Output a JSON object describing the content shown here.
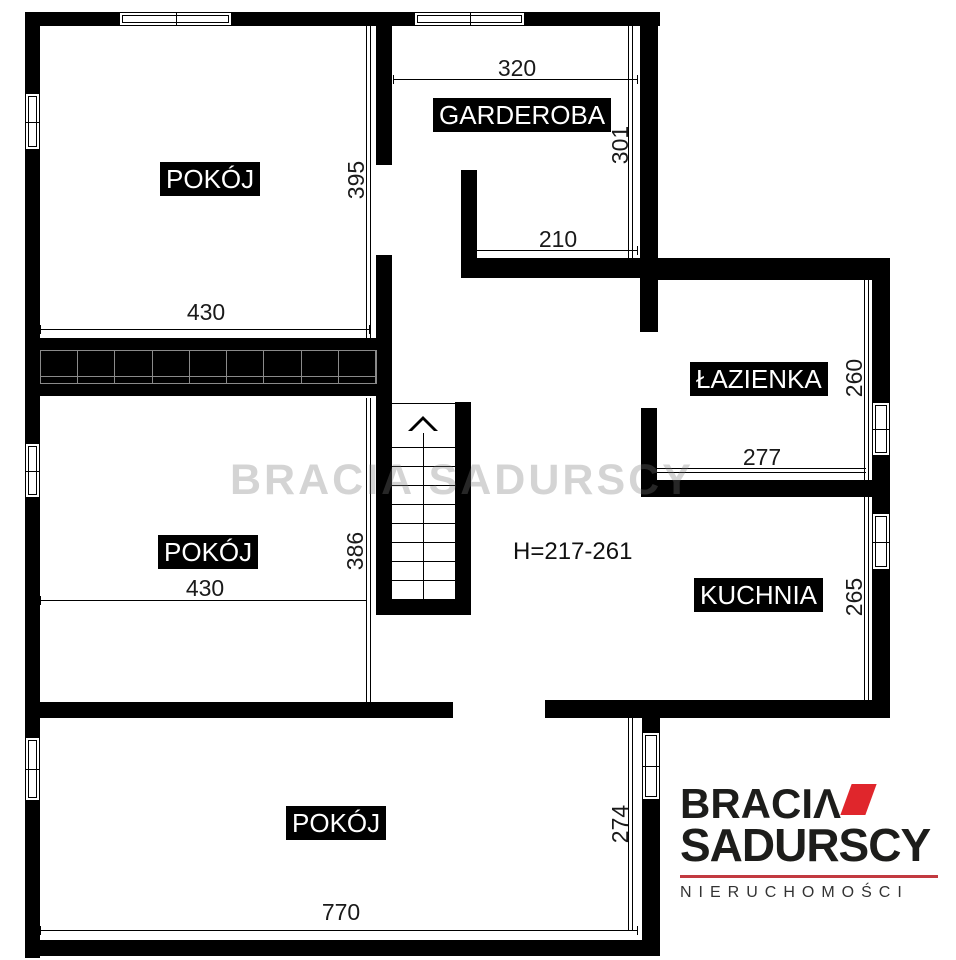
{
  "rooms": {
    "pokoj_top": "POKÓJ",
    "garderoba": "GARDEROBA",
    "lazienka": "ŁAZIENKA",
    "pokoj_middle": "POKÓJ",
    "kuchnia": "KUCHNIA",
    "pokoj_bottom": "POKÓJ"
  },
  "dims": {
    "garderoba_w": "320",
    "garderoba_h": "301",
    "garderoba_inner_w": "210",
    "pokoj_top_h": "395",
    "pokoj_top_w": "430",
    "lazienka_h": "260",
    "lazienka_w": "277",
    "pokoj_middle_w": "430",
    "pokoj_middle_h": "386",
    "kuchnia_h": "265",
    "pokoj_bottom_h": "274",
    "pokoj_bottom_w": "770"
  },
  "height_note": "H=217-261",
  "watermark": "BRACIA SADURSCY",
  "logo": {
    "line1": "BRACIΛ",
    "line2": "SADURSCY",
    "line3": "NIERUCHOMOŚCI",
    "accent_color": "#e0262c",
    "rule_color": "#c23a40",
    "text_color": "#1d1d1b"
  },
  "colors": {
    "wall": "#000000",
    "background": "#ffffff",
    "dimension_text": "#1a1a1a"
  }
}
